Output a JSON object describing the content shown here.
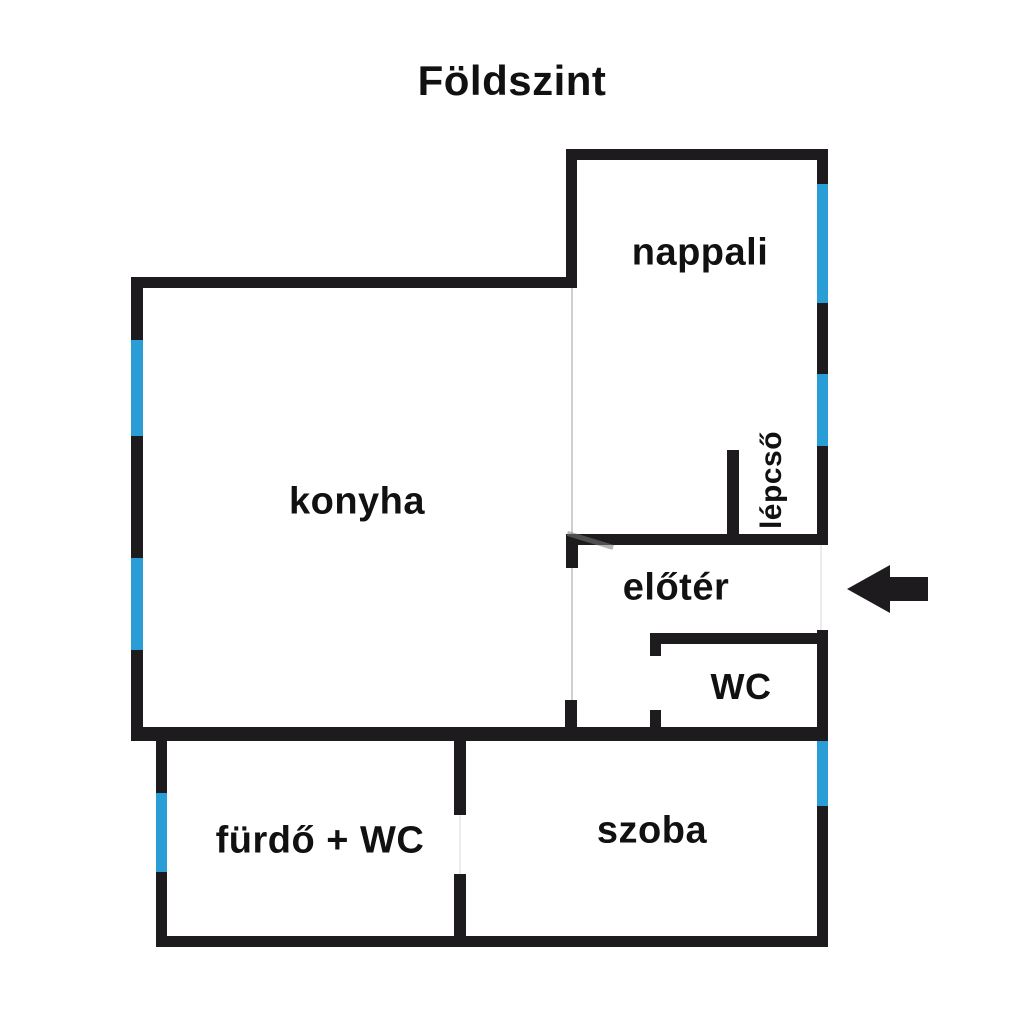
{
  "title": "Földszint",
  "colors": {
    "wall": "#1d1b1e",
    "window": "#2b9dd6",
    "text": "#111111",
    "background": "#ffffff",
    "thin": "#cfcfcf"
  },
  "rooms": [
    {
      "id": "nappali",
      "label": "nappali"
    },
    {
      "id": "konyha",
      "label": "konyha"
    },
    {
      "id": "lepcso",
      "label": "lépcső"
    },
    {
      "id": "eloter",
      "label": "előtér"
    },
    {
      "id": "wc",
      "label": "WC"
    },
    {
      "id": "furdo-wc",
      "label": "fürdő + WC"
    },
    {
      "id": "szoba",
      "label": "szoba"
    }
  ],
  "entrance": {
    "arrow_direction": "left"
  }
}
